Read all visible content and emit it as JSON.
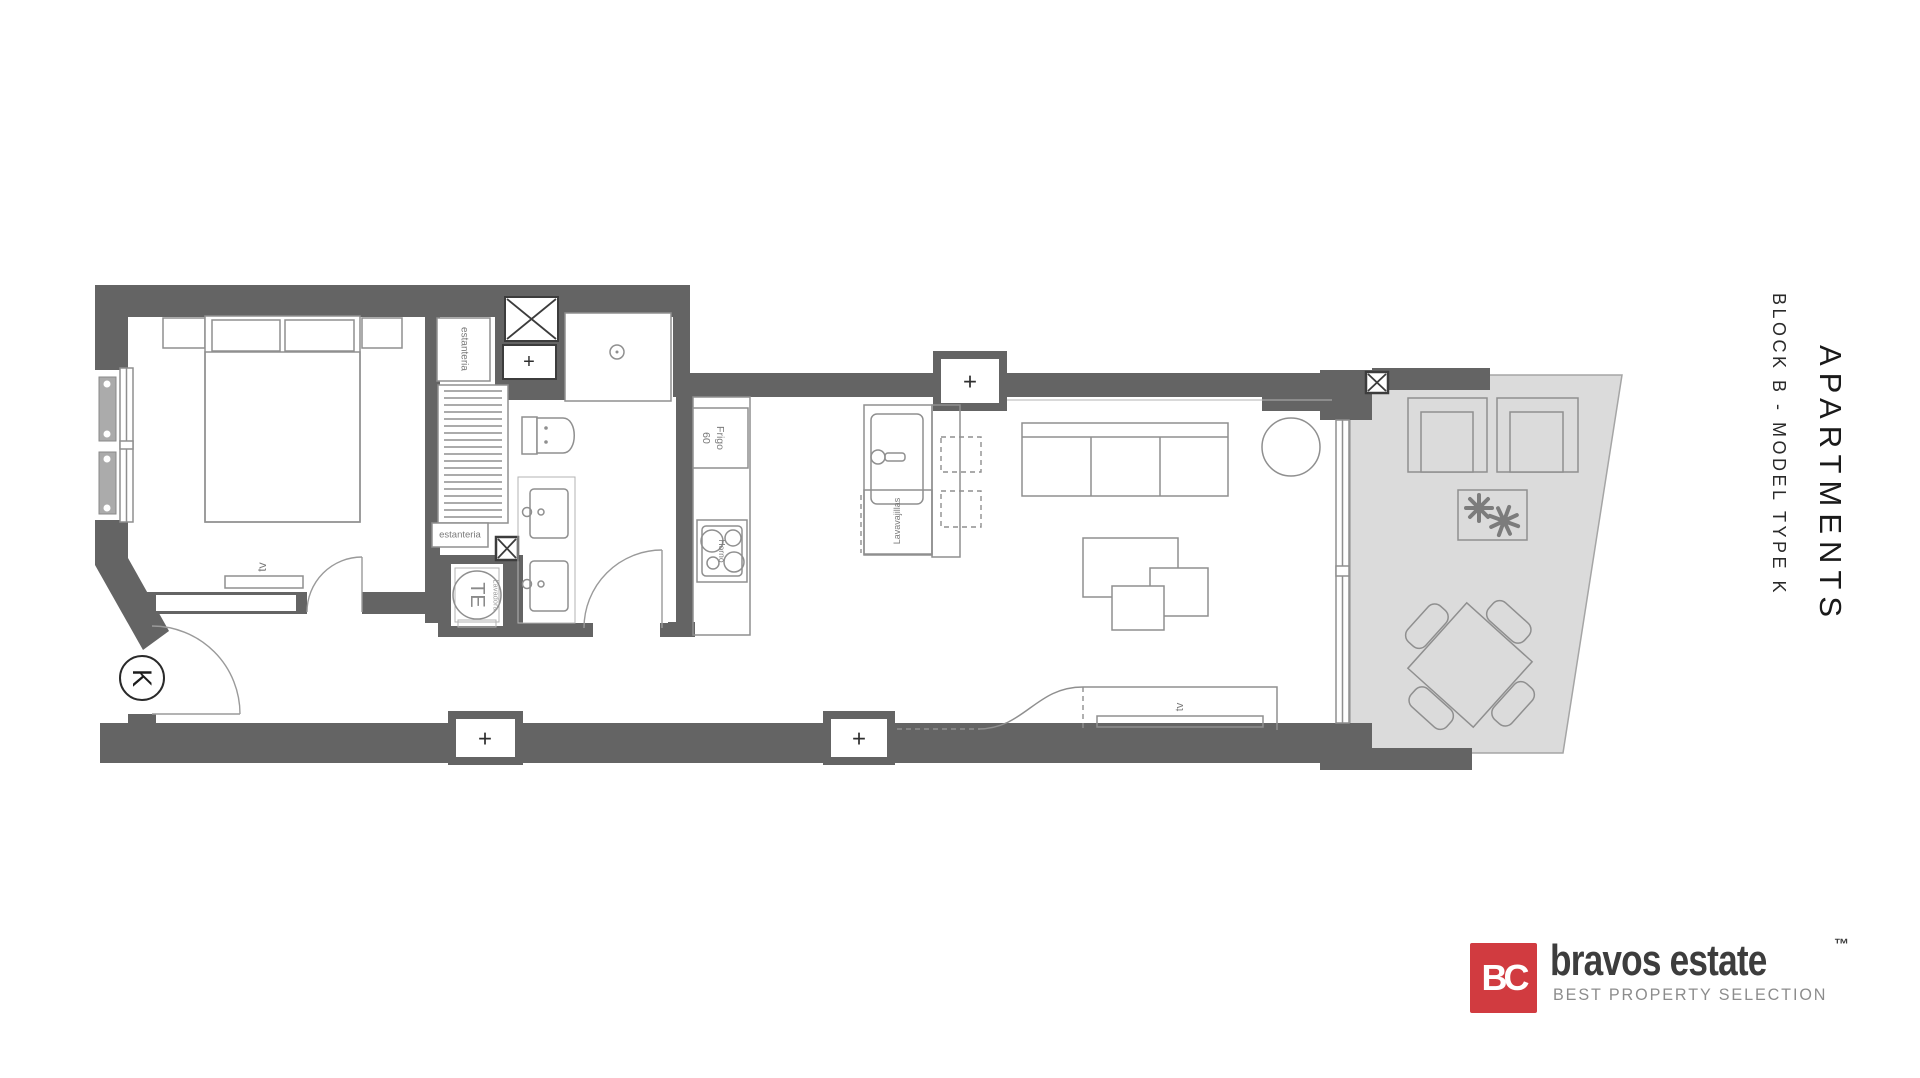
{
  "title_block": {
    "main": "APARTMENTS",
    "sub": "BLOCK B - MODEL TYPE K"
  },
  "logo": {
    "monogram": "BC",
    "name": "bravos estate",
    "trademark": "™",
    "tagline": "BEST PROPERTY SELECTION"
  },
  "colors": {
    "wall": "#646464",
    "line": "#8f8f8f",
    "terrace": "#dbdbdb",
    "accent": "#d13b40"
  },
  "plan": {
    "labels": {
      "shelf_vertical": "estanteria",
      "shelf_horizontal": "estanteria",
      "washer": "TE",
      "washer_small": "Lavadora",
      "fridge": "Frigo",
      "fridge_size": "60",
      "oven": "Horno",
      "dishwasher": "Lavavajillas",
      "bedroom_tv": "tv",
      "living_tv": "tv",
      "entry": "K",
      "plus": "+"
    }
  }
}
